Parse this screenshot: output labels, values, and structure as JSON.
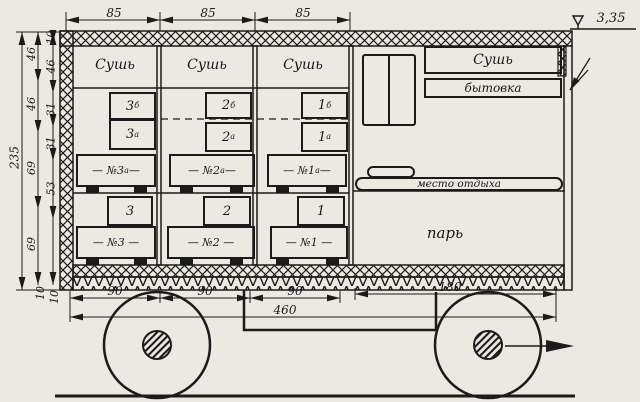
{
  "dims": {
    "top": [
      "85",
      "85",
      "85"
    ],
    "bottom": [
      "90",
      "90",
      "90",
      "180"
    ],
    "bottom_overall": "460",
    "left_overall": "235",
    "left_chain_a": [
      "46",
      "46",
      "69",
      "69"
    ],
    "left_chain_b": [
      "10",
      "46",
      "31",
      "31",
      "53"
    ],
    "floor_thickness": [
      "10",
      "10"
    ],
    "elevation": "3,35"
  },
  "rooms": {
    "dry1": "Сушь",
    "dry2": "Сушь",
    "dry3": "Сушь",
    "dry_right": "Сушь",
    "utility": "бытовка",
    "rest_area": "место отдыха",
    "steam": "парь"
  },
  "racks": {
    "upper": [
      {
        "top_num": "3",
        "top_sup": "б",
        "mid_num": "3",
        "mid_sup": "а",
        "label_pre": "— №3",
        "label_sup": "а",
        "label_post": " —"
      },
      {
        "top_num": "2",
        "top_sup": "б",
        "mid_num": "2",
        "mid_sup": "а",
        "label_pre": "— №2",
        "label_sup": "а",
        "label_post": " —"
      },
      {
        "top_num": "1",
        "top_sup": "б",
        "mid_num": "1",
        "mid_sup": "а",
        "label_pre": "— №1",
        "label_sup": "а",
        "label_post": " —"
      }
    ],
    "lower": [
      {
        "num": "3",
        "label": "— №3 —"
      },
      {
        "num": "2",
        "label": "— №2 —"
      },
      {
        "num": "1",
        "label": "— №1 —"
      }
    ]
  }
}
